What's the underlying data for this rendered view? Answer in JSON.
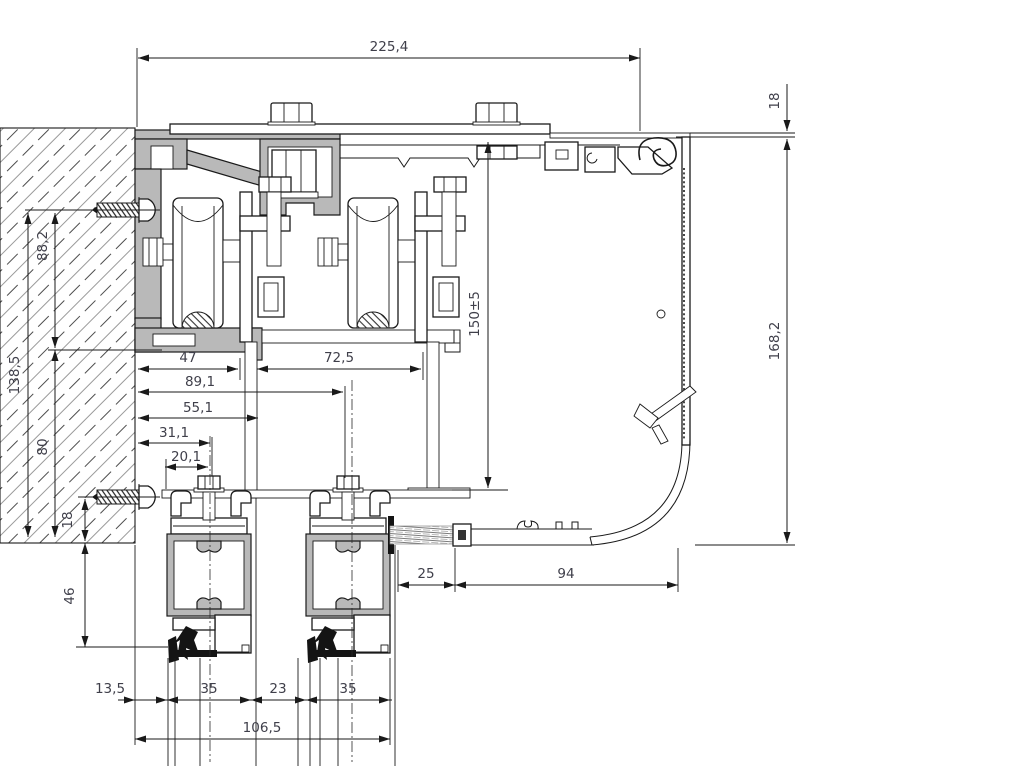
{
  "drawing": {
    "kind": "aluminium sliding-door top-track cross-section",
    "units_style": "comma-decimal millimetres",
    "colors": {
      "line": "#1a1a1a",
      "aluminum_fill": "#b9b9b9",
      "dim_text": "#3f3f4a",
      "background": "#ffffff"
    }
  },
  "dimensions": {
    "d225_4": {
      "label": "225,4"
    },
    "d18_right": {
      "label": "18"
    },
    "d168_2": {
      "label": "168,2"
    },
    "d88_2": {
      "label": "88,2"
    },
    "d138_5": {
      "label": "138,5"
    },
    "d80": {
      "label": "80"
    },
    "d18_left": {
      "label": "18"
    },
    "d46": {
      "label": "46"
    },
    "d47": {
      "label": "47"
    },
    "d72_5": {
      "label": "72,5"
    },
    "d89_1": {
      "label": "89,1"
    },
    "d55_1": {
      "label": "55,1"
    },
    "d31_1": {
      "label": "31,1"
    },
    "d20_1": {
      "label": "20,1"
    },
    "d150": {
      "label": "150±5"
    },
    "d25": {
      "label": "25"
    },
    "d94": {
      "label": "94"
    },
    "d13_5": {
      "label": "13,5"
    },
    "d35_a": {
      "label": "35"
    },
    "d23": {
      "label": "23"
    },
    "d35_b": {
      "label": "35"
    },
    "d106_5": {
      "label": "106,5"
    }
  }
}
